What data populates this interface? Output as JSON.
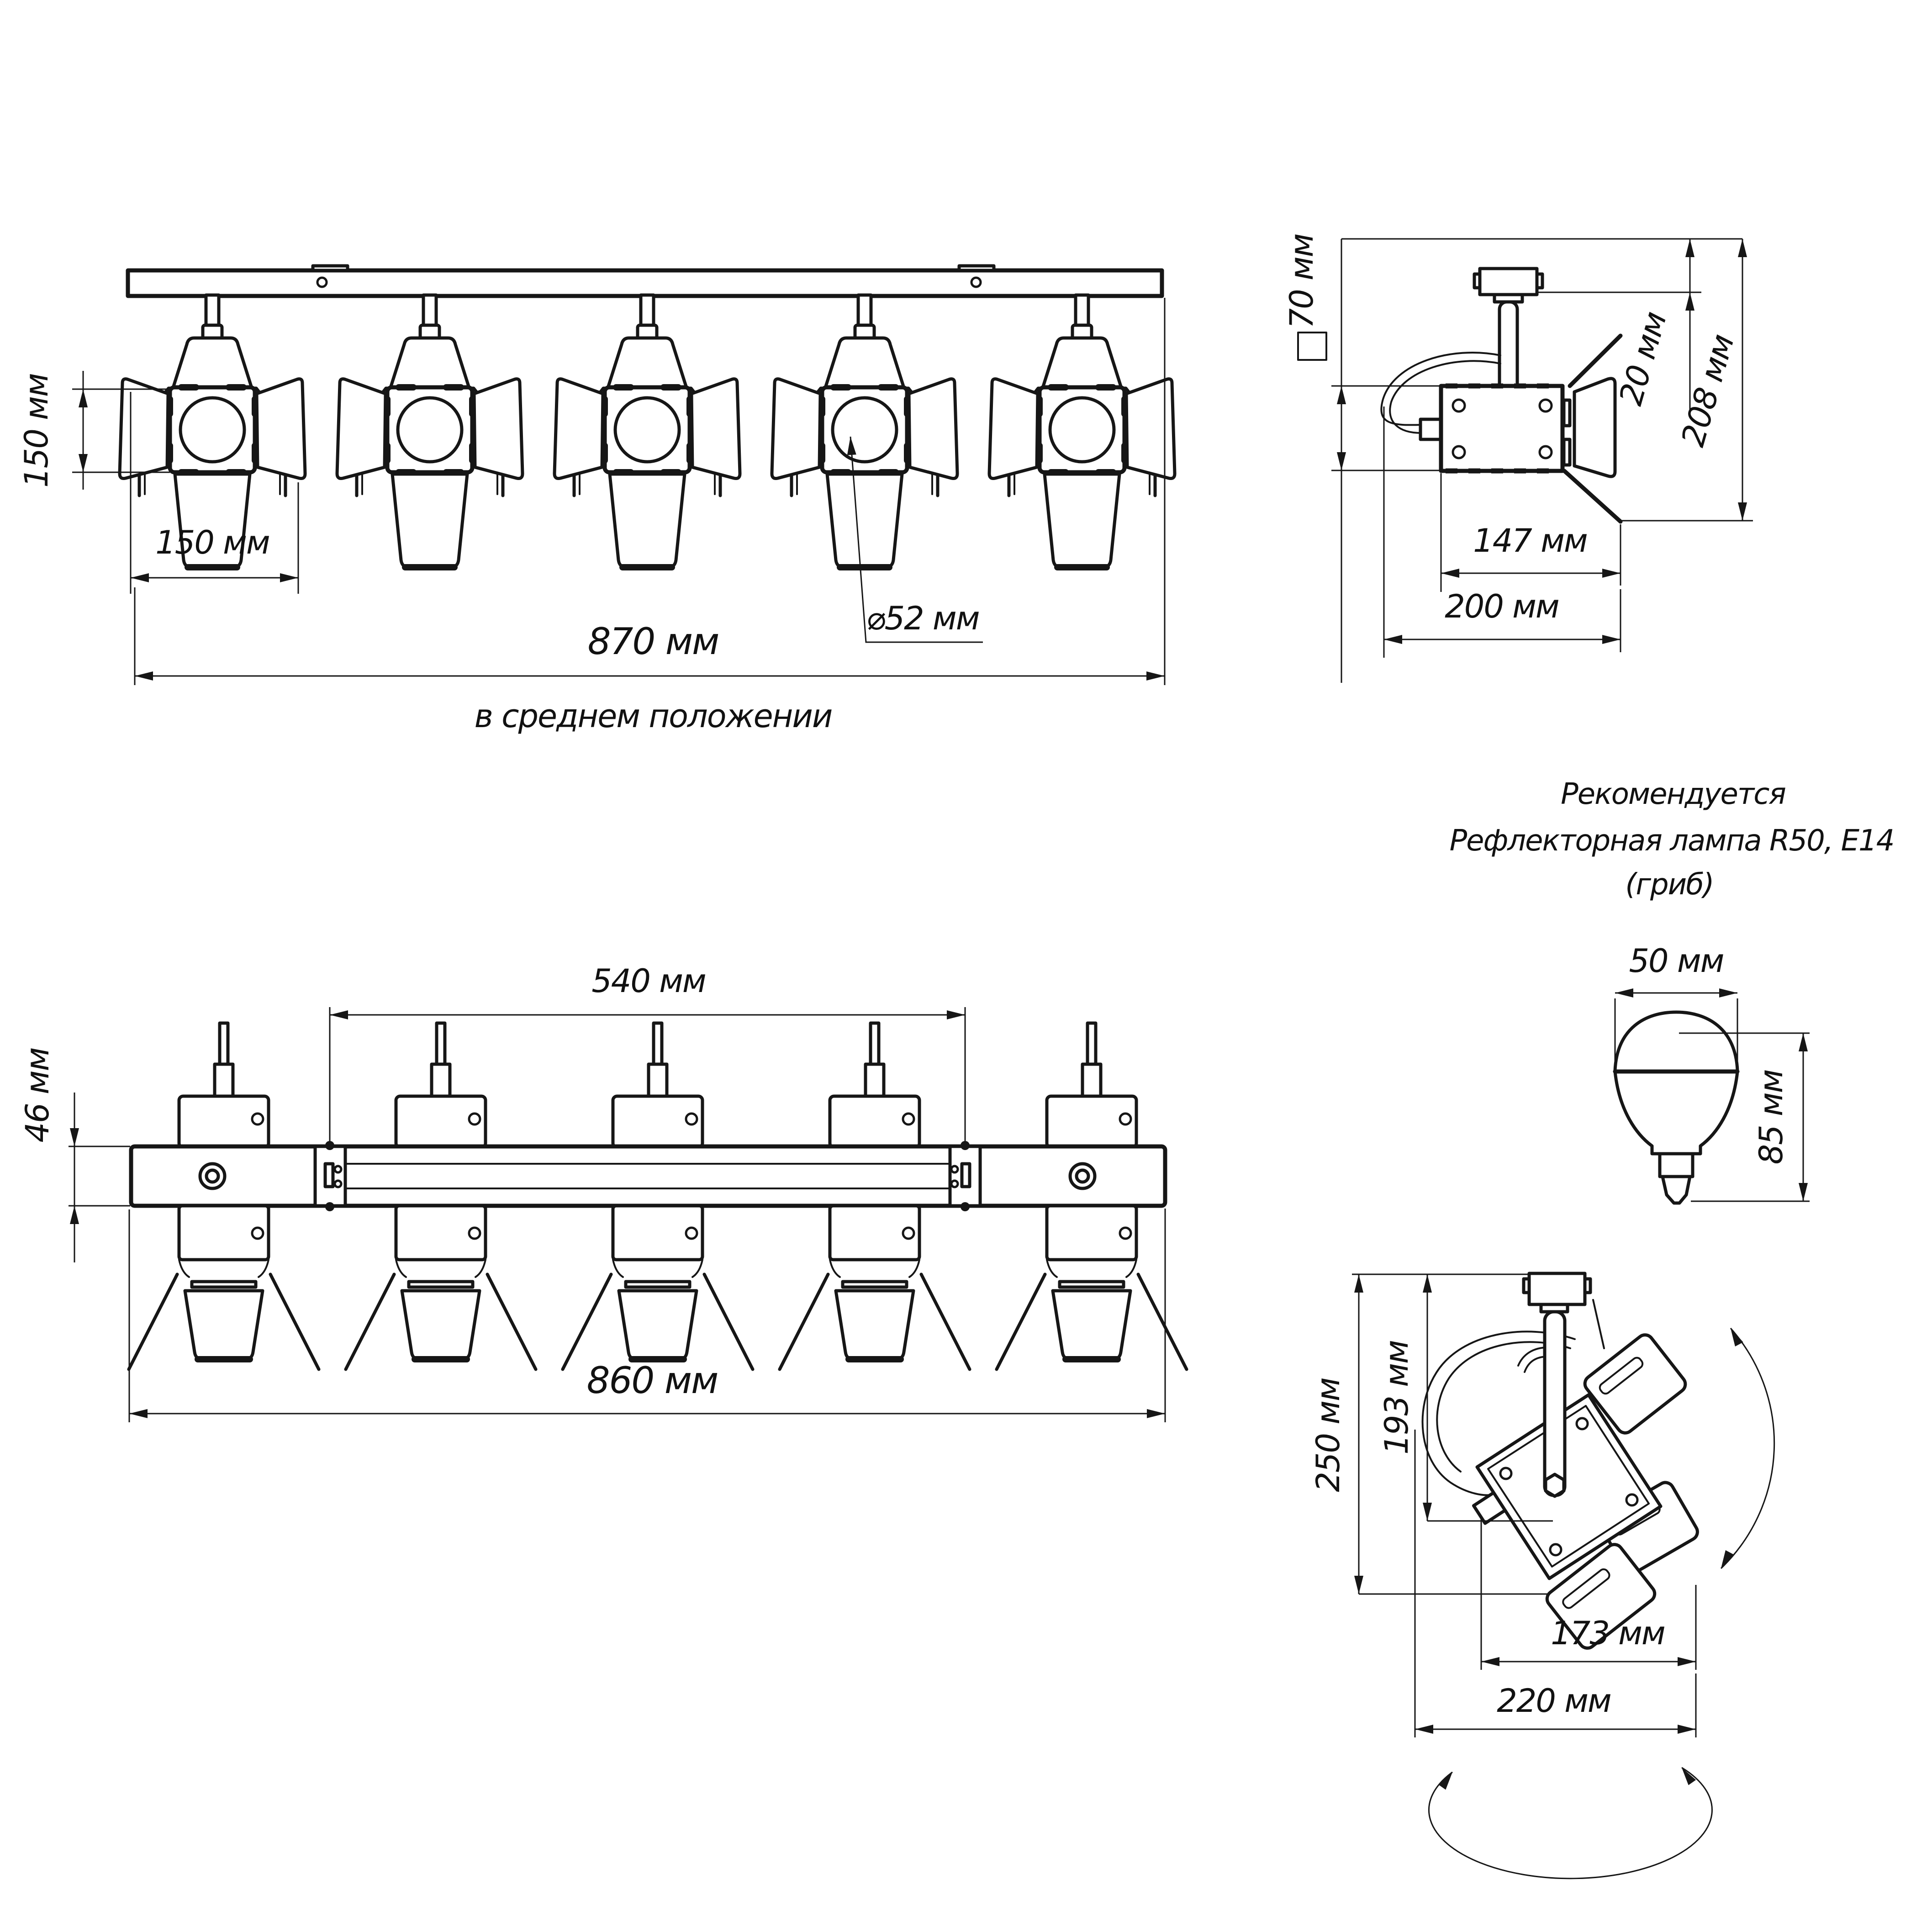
{
  "front": {
    "h150": "150 мм",
    "w150": "150 мм",
    "total": "870 мм",
    "note": "в среднем положении",
    "lens": "⌀52 мм"
  },
  "side": {
    "sq": "70 мм",
    "gap": "20 мм",
    "h": "208 мм",
    "body": "147 мм",
    "total": "200 мм"
  },
  "rec": {
    "l1": "Рекомендуется",
    "l2": "Рефлекторная лампа R50, E14",
    "l3": "(гриб)"
  },
  "bulb": {
    "d": "50 мм",
    "h": "85 мм"
  },
  "plan": {
    "span": "540 мм",
    "bar": "46 мм",
    "total": "860 мм"
  },
  "tilt": {
    "h1": "250 мм",
    "h2": "193 мм",
    "w1": "173 мм",
    "w2": "220 мм"
  }
}
